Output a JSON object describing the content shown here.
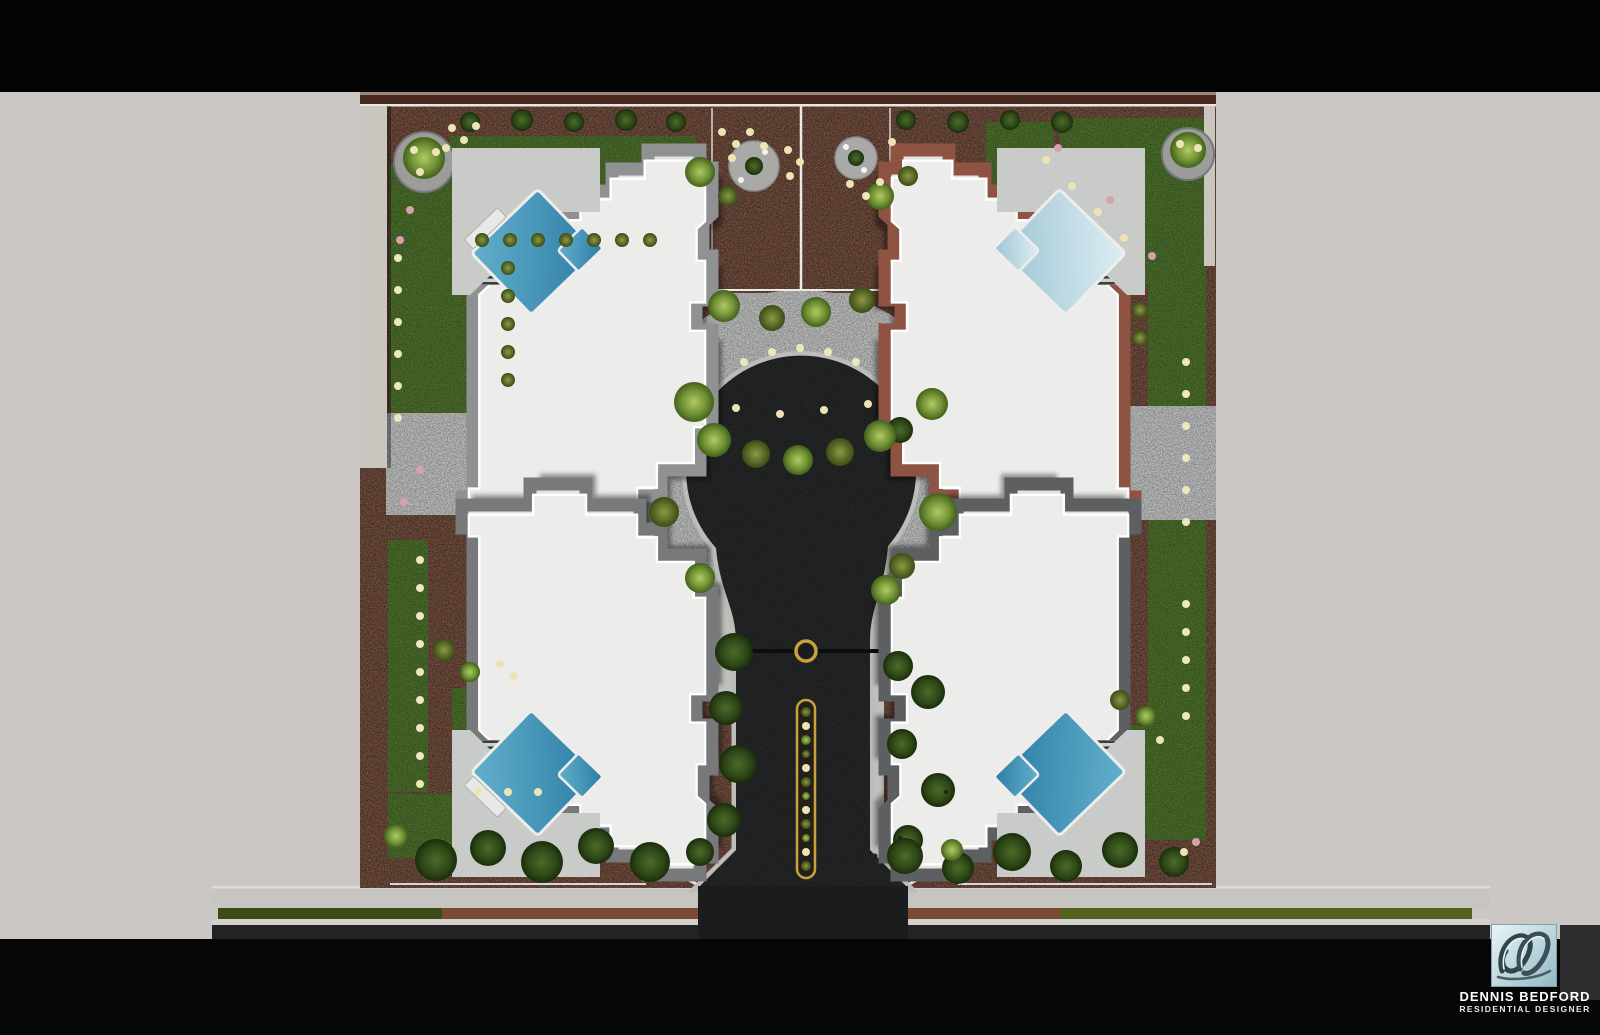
{
  "credit": {
    "name": "DENNIS BEDFORD",
    "role": "RESIDENTIAL DESIGNER"
  },
  "logo": {
    "icon": "db-script-monogram-logo"
  },
  "scene": {
    "type": "aerial residential site plan rendering",
    "houses_visible": 4,
    "pools_visible": 4,
    "features": [
      "keyhole cul-de-sac driveway",
      "gold-edged entry median planter",
      "paver motor court",
      "lawns",
      "mulch planting beds",
      "perimeter wall",
      "street with sidewalk and parkway"
    ]
  },
  "palette": {
    "background_gray": "#cac7c5",
    "banner_black": "#050505",
    "mulch_brown": "#774733",
    "lawn_green": "#4e7a26",
    "paver_gray": "#b5b8ba",
    "asphalt": "#1b1c1d",
    "roof_white": "#ececea",
    "roof_trim_gray": "#8f9193",
    "roof_trim_red": "#8e5343",
    "pool_blue": "#4598bb",
    "pool_pale": "#b7d4df",
    "gold_accent": "#c9a13d"
  }
}
